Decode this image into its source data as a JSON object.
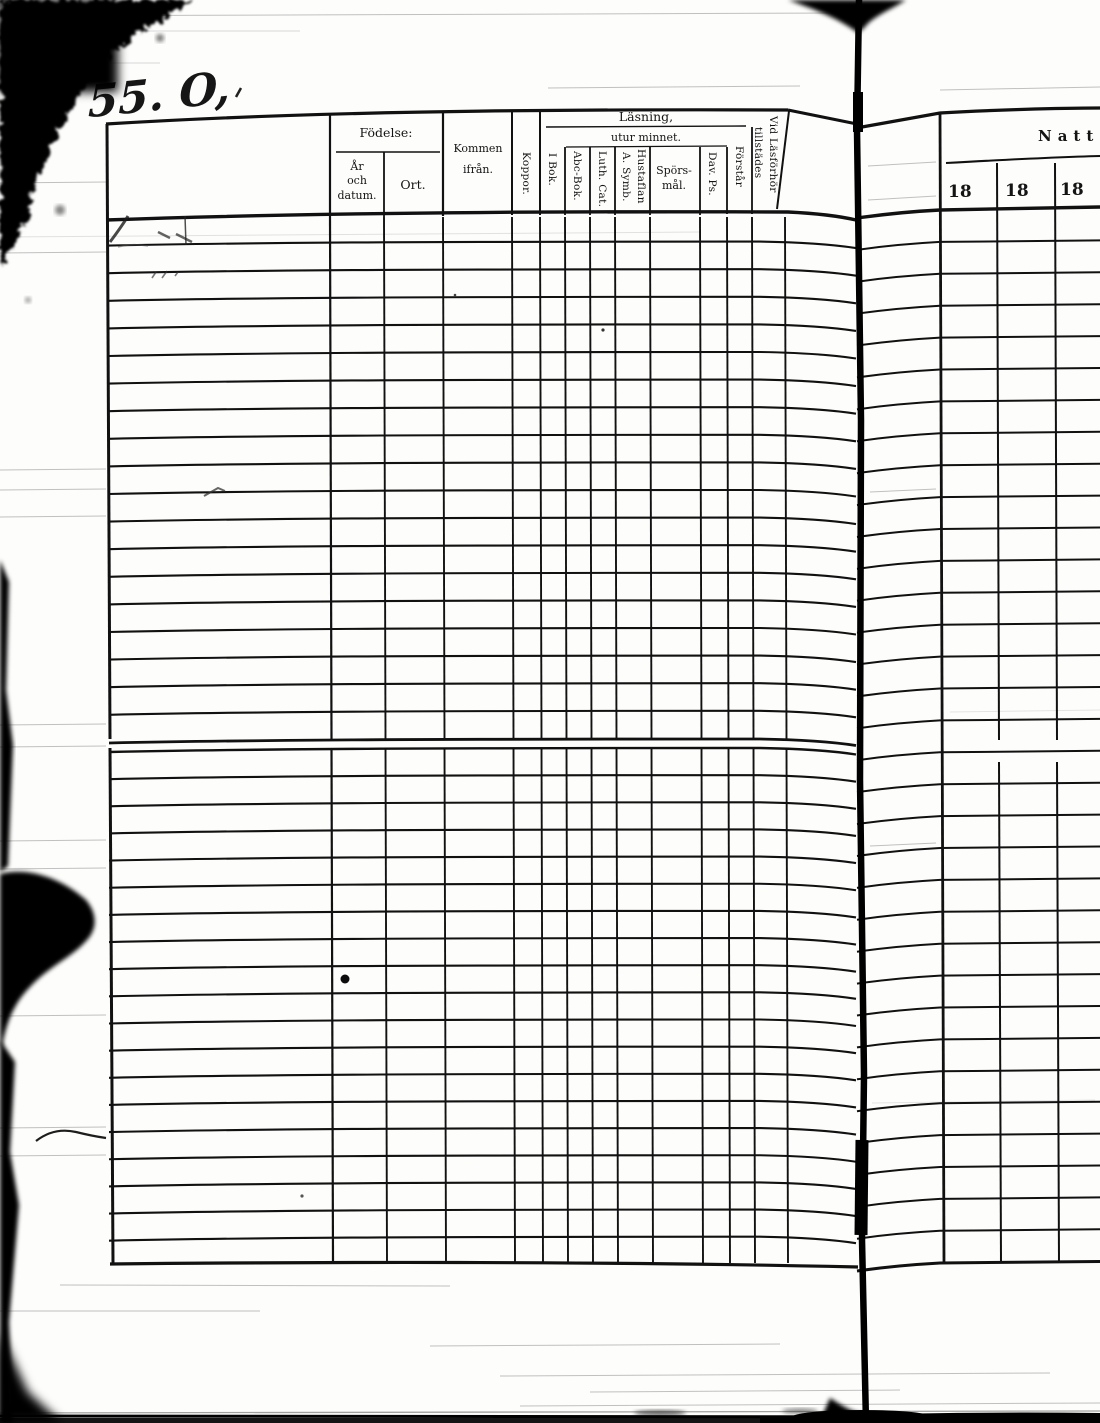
{
  "handwriting": {
    "number": "55. O,"
  },
  "left_page": {
    "header": {
      "fodelse": {
        "group": "Födelse:",
        "ar_och_datum": [
          "År",
          "och",
          "datum."
        ],
        "ort": "Ort."
      },
      "kommen_ifran": [
        "Kommen",
        "ifrån."
      ],
      "koppor": "Koppor.",
      "lasning": {
        "group": "Läsning,",
        "i_bok": "I Bok.",
        "utur_minnet": {
          "group": "utur minnet.",
          "abc_bok": "Abc-Bok.",
          "luth_cat": "Luth. Cat.",
          "a_symb": "A. Symb.",
          "hustaflan": "Hustaflan",
          "spors_mal": [
            "Spörs-",
            "mål."
          ],
          "dav_ps": "Dav. Ps."
        },
        "forstar": "Förstår"
      },
      "vid_lasforhor": [
        "Vid Läsförhör",
        "tillstädes"
      ]
    }
  },
  "right_page": {
    "header": {
      "title": "Natt",
      "years": [
        "18",
        "18",
        "18"
      ]
    }
  }
}
